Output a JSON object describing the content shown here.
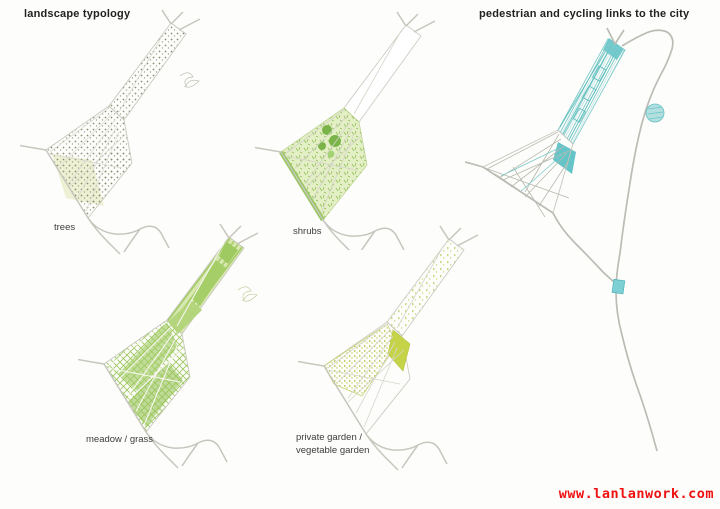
{
  "titles": {
    "left": "landscape typology",
    "right": "pedestrian and cycling links to the city"
  },
  "maps": [
    {
      "id": "trees",
      "label": "trees"
    },
    {
      "id": "shrubs",
      "label": "shrubs"
    },
    {
      "id": "meadow",
      "label": "meadow / grass"
    },
    {
      "id": "garden",
      "label_line1": "private garden /",
      "label_line2": "vegetable garden"
    },
    {
      "id": "links",
      "label": "pedestrian and cycling links to the city"
    }
  ],
  "legend_colors": {
    "road_gray": "#c6c6bd",
    "trees_dot": "#8d8d75",
    "trees_patch": "#eef0d3",
    "shrub_green": "#7ab449",
    "shrub_wash": "#e4efc5",
    "meadow_green": "#a2cb64",
    "garden_yellow_green": "#c5d348",
    "links_teal": "#64c4c8"
  },
  "watermark": {
    "text": "www.lanlanwork.com",
    "color": "#ee1111"
  }
}
